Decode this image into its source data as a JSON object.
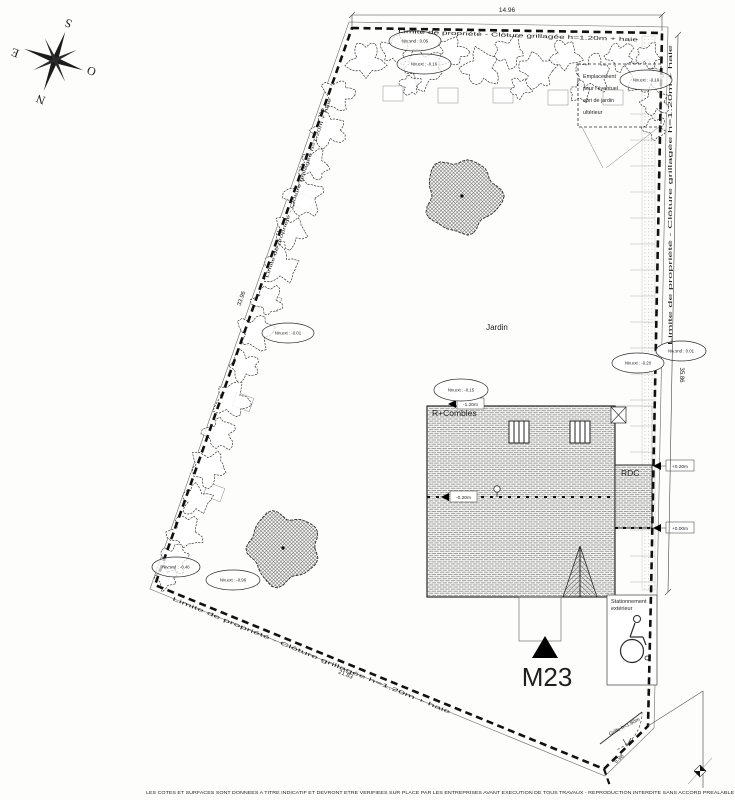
{
  "colors": {
    "paper": "#fdfdfc",
    "ink": "#1f1f1f",
    "hatch_gray": "#8f8f8d"
  },
  "compass": {
    "south": "S",
    "north": "N",
    "east": "E",
    "west": "O"
  },
  "boundary": {
    "label": "Limite de propriété - Clôture grillagée h=1.20m + haie"
  },
  "dimensions": {
    "top": "14.96",
    "right": "35.86",
    "left": "33.96",
    "bottom": "21.83",
    "gate": "5.98"
  },
  "garden": {
    "label": "Jardin"
  },
  "shed_note": {
    "line1": "Emplacement",
    "line2": "pour l'éventuel",
    "line3": "abri de jardin",
    "line4": "ultérieur"
  },
  "building": {
    "roof_label": "R+Combles",
    "ground_floor_label": "RDC",
    "attic_level": "-1.20m",
    "section_level": "-0.20m",
    "rdc_level": "+0.20m",
    "exterior_level": "+0.00m"
  },
  "levels": [
    {
      "text": "Niv.snd : 0.06"
    },
    {
      "text": "Niv.ext : -0.16"
    },
    {
      "text": "Niv.ext : -0.10"
    },
    {
      "text": "Niv.ext : -0.01"
    },
    {
      "text": "Niv.ext : -0.20"
    },
    {
      "text": "Niv.snd : 0.01"
    },
    {
      "text": "Niv.ext : -0.15"
    },
    {
      "text": "Niv.snd : -0.46"
    },
    {
      "text": "Niv.ext : -0.96"
    }
  ],
  "parking": {
    "line1": "Stationnement",
    "line2": "extérieur"
  },
  "marker": {
    "label": "M23"
  },
  "gate": {
    "label": "Grille h=1.60m"
  },
  "footer": {
    "text": "LES COTES ET SURFACES SONT DONNEES A TITRE INDICATIF ET DEVRONT ETRE VERIFIEES SUR PLACE PAR LES ENTREPRISES AVANT EXECUTION DE TOUS TRAVAUX - REPRODUCTION INTERDITE SANS ACCORD PREALABLE"
  }
}
